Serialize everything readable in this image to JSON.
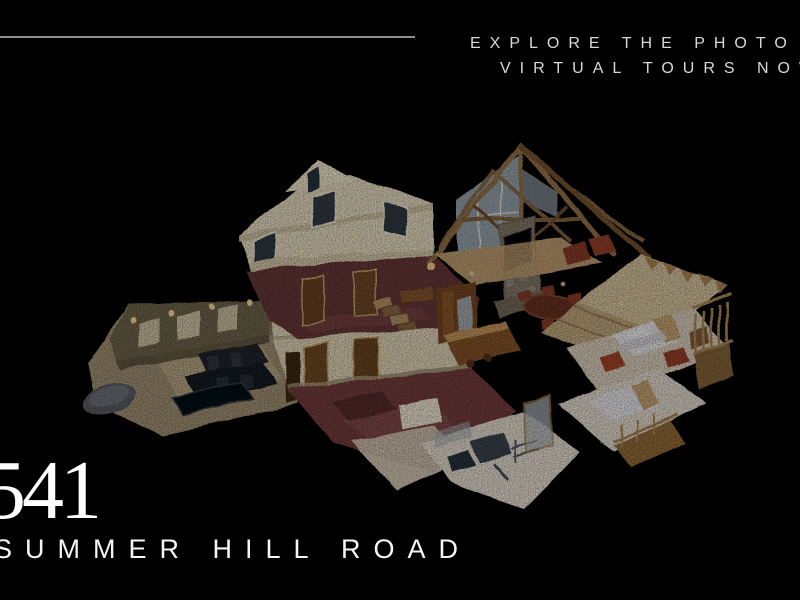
{
  "background_color": "#000000",
  "header": {
    "rule_color": "#8e8e8e",
    "promo_line1": "EXPLORE THE PHOTO &",
    "promo_line2": "VIRTUAL TOURS NOW"
  },
  "hero": {
    "name": "3D dollhouse virtual tour preview",
    "description": "Isometric Matterport-style dollhouse cutaway of a multi-level timber-frame home: home-theater wing with dark leather recliners and poster walls on the left; two-story cream living block with burgundy carpet, wood doors and staircase in the center; vaulted great room with exposed wood roof trusses, glass gable wall, stone fireplace with TV and kitchen; gabled bedroom wing with white beds, red armchairs and a railed balcony on the right; home gym with exercise equipment at the lower tip.",
    "palette": {
      "wall_cream": "#e9dec3",
      "carpet_burgundy": "#6d4141",
      "floor_red": "#7a4545",
      "wood_beam": "#9a7850",
      "roof_tan": "#d8c6a0",
      "theater_carpet": "#a59478",
      "seat_black": "#2a2e34",
      "bed_white": "#eceaec",
      "accent_red_chair": "#a84e32",
      "glass_blue": "#9ba8b0",
      "light_gold": "#ffda8f"
    }
  },
  "address": {
    "number": "541",
    "street": "SUMMER HILL ROAD"
  }
}
